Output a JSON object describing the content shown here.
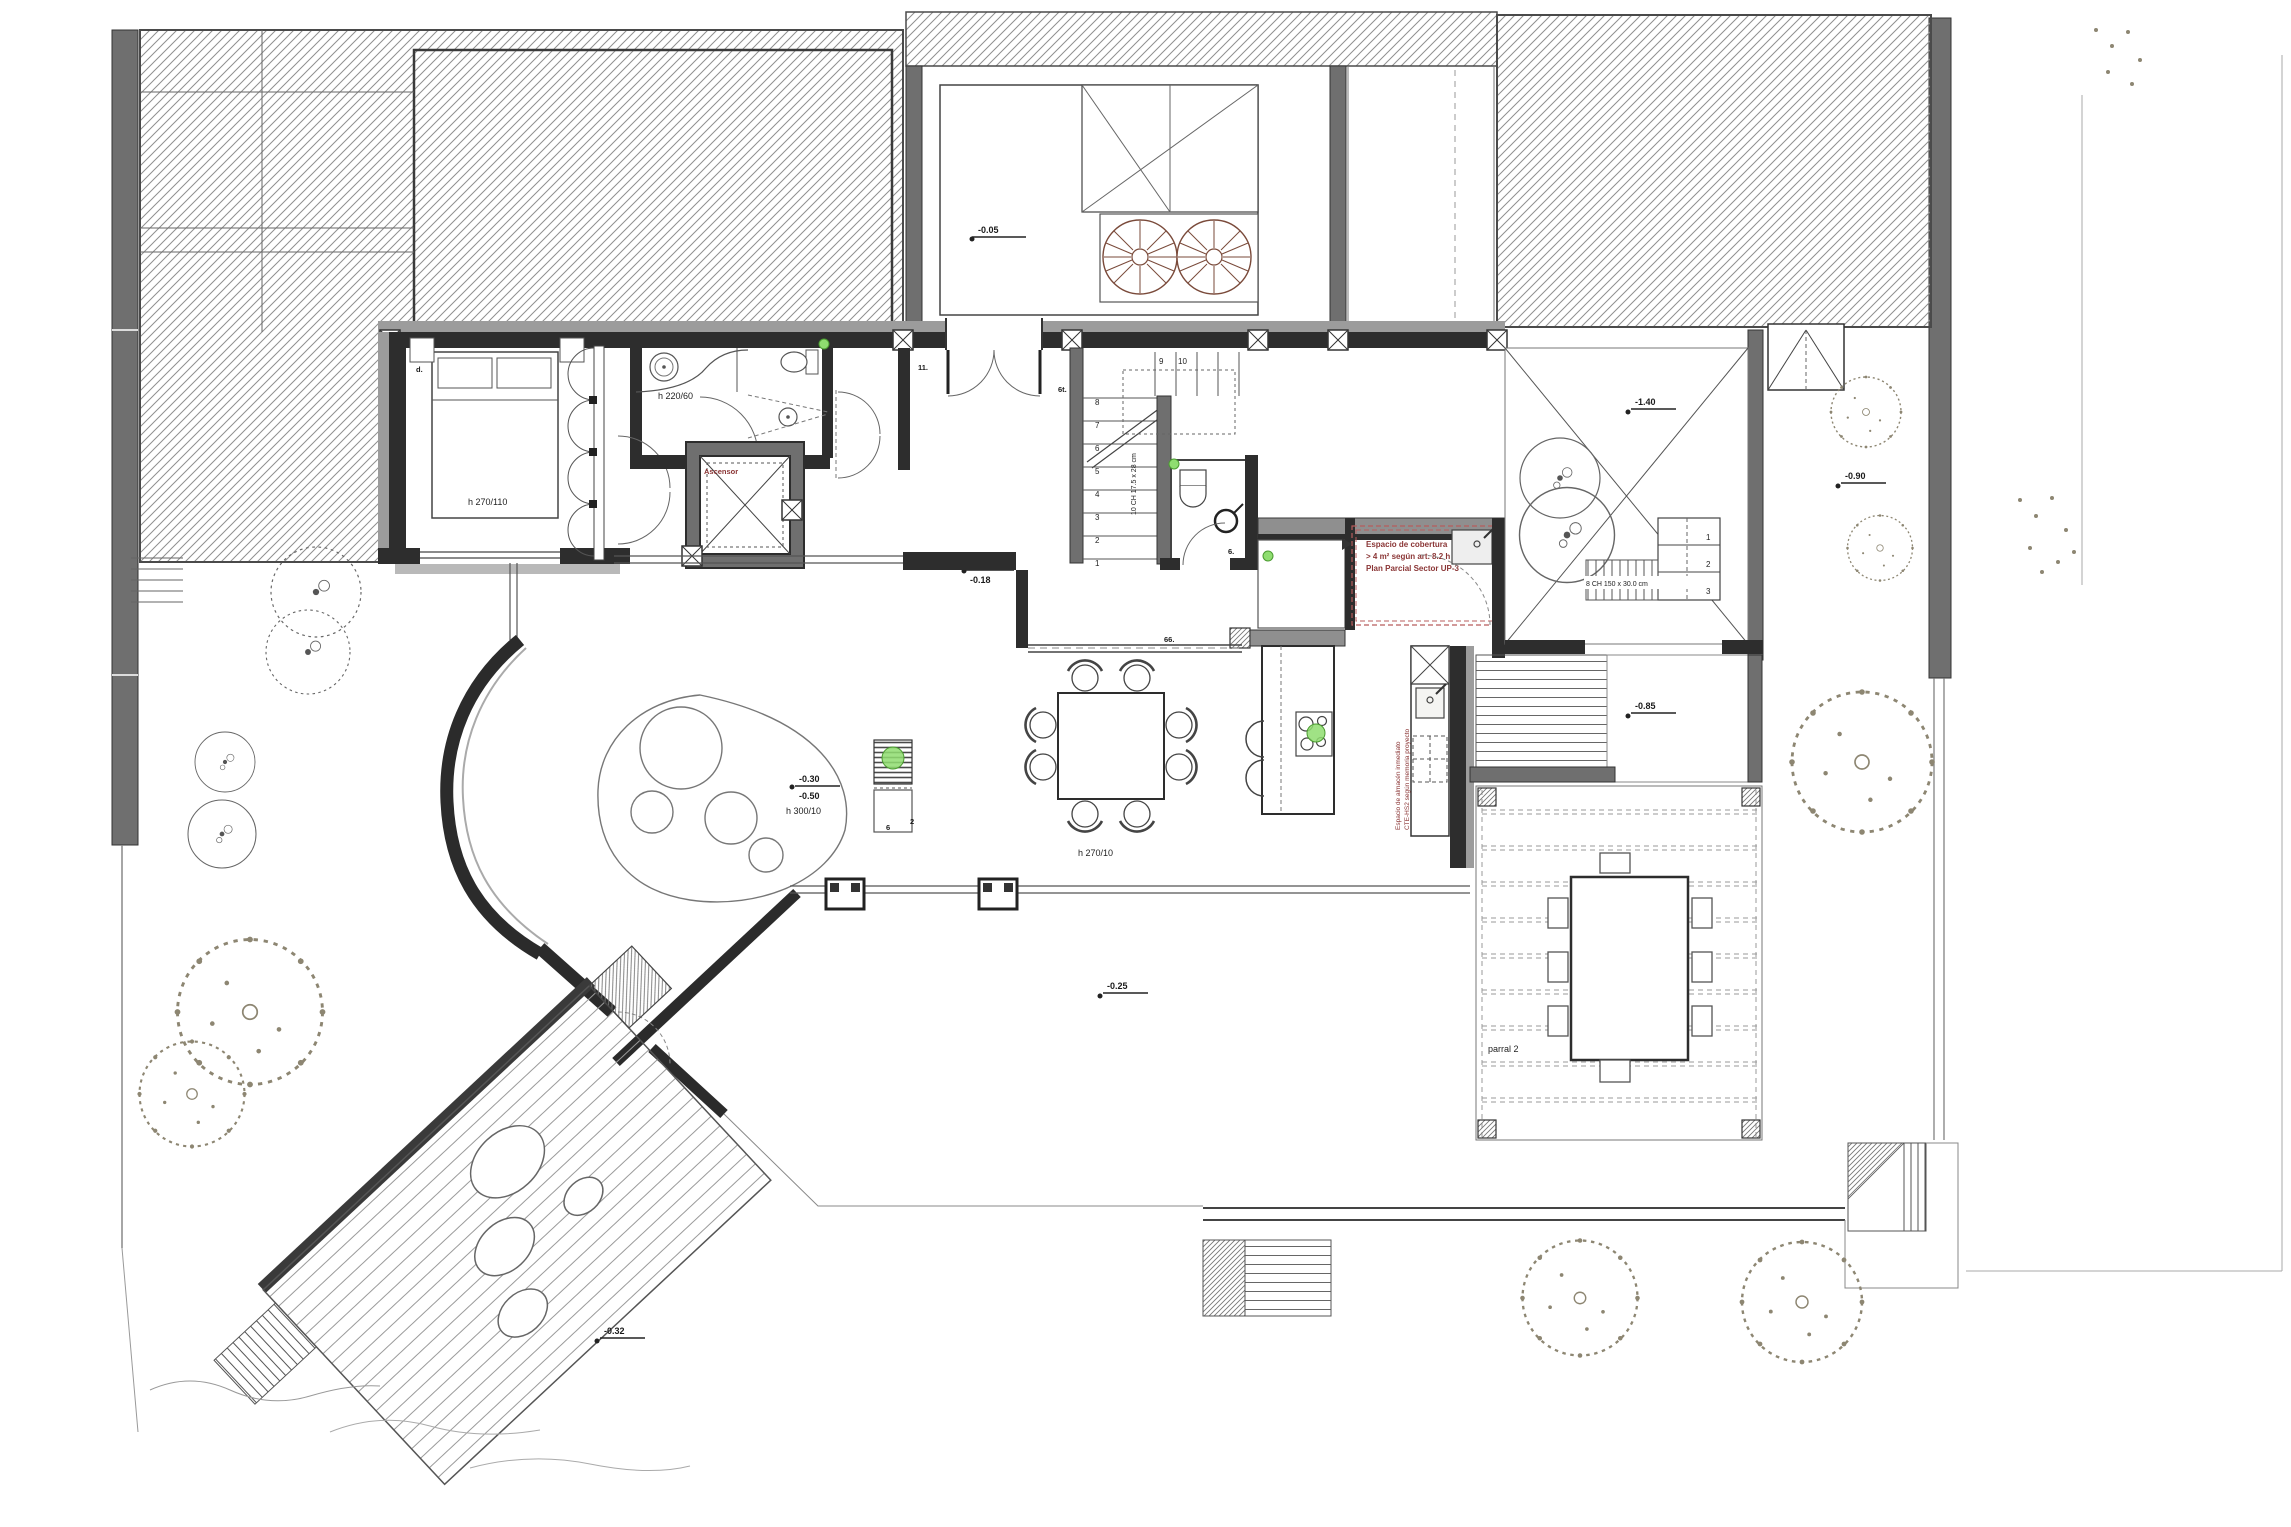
{
  "drawing": {
    "type": "architectural ground floor plan",
    "levels": {
      "entry": "-0.05",
      "hall_upper": "±0.00",
      "hall_lower": "-0.18",
      "terrace_ne": "-1.40",
      "living_upper": "-0.30",
      "living_lower": "-0.50",
      "patio_east": "-0.85",
      "garden_east": "-0.90",
      "terrace_south": "-0.25",
      "deck": "-0.32"
    },
    "heights": {
      "bedroom": "h 270/110",
      "bathroom": "h 220/60",
      "living": "h 300/10",
      "dining": "h 270/10"
    },
    "rooms": {
      "elevator": "Ascensor",
      "pergola": "parral 2"
    },
    "annotations": {
      "laundry_box": [
        "Espacio de cobertura",
        "> 4 m² según art. 8.2 h",
        "Plan Parcial Sector UP-3"
      ],
      "storage_vertical": [
        "Espacio de almacén inmediato",
        "CTE-HS2 según memoria proyecto"
      ],
      "stair_exterior": "8 CH 150 x 30.0 cm",
      "stair_interior": "10 CH 17.5 x 28 cm"
    },
    "stairs": {
      "main_numbers": [
        "1",
        "2",
        "3",
        "4",
        "5",
        "6",
        "7",
        "8",
        "9",
        "10"
      ],
      "terrace_numbers": [
        "1",
        "2",
        "3"
      ]
    },
    "tags": {
      "bedroom": "d.",
      "hall_a": "11.",
      "hall_b": "6t.",
      "dining": "66.",
      "wc": "6.",
      "media_a": "6",
      "media_b": "2"
    },
    "colors": {
      "wall_dark": "#2d2d2d",
      "wall_gray": "#6f6f6f",
      "annotation_red": "#8a3535",
      "marker_green": "#8fdd70",
      "tree_olive": "#8d8672"
    }
  }
}
